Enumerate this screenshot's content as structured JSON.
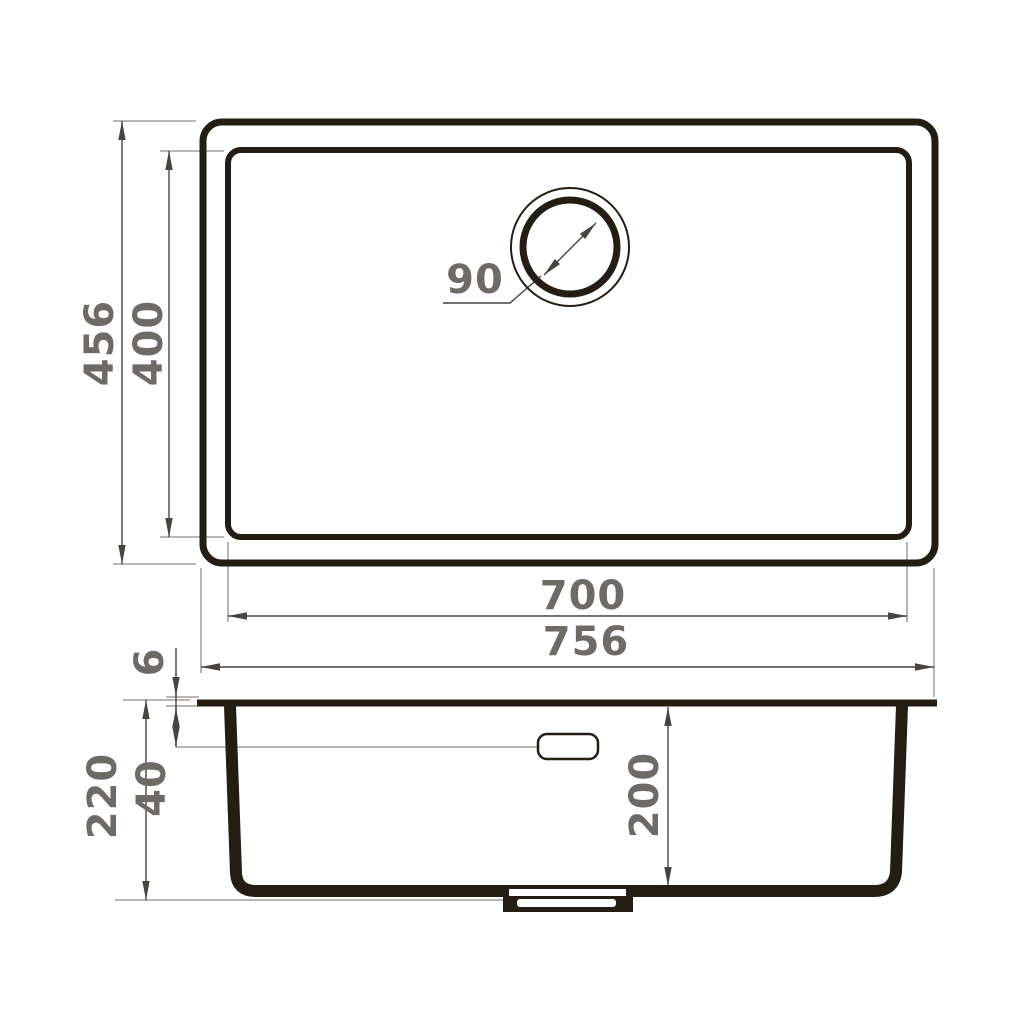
{
  "drawing": {
    "type": "sink-technical-drawing",
    "colors": {
      "heavy_line": "#261d12",
      "dimension_line": "#47433f",
      "extension_line": "#8f8b87",
      "label_text": "#6e6a66",
      "background": "#ffffff"
    },
    "top_view": {
      "outer_width": "756",
      "inner_width": "700",
      "outer_depth": "456",
      "inner_depth": "400",
      "drain_diameter": "90"
    },
    "side_view": {
      "overall_height": "220",
      "rim_thickness": "6",
      "overflow_offset": "40",
      "bowl_depth": "200"
    }
  }
}
